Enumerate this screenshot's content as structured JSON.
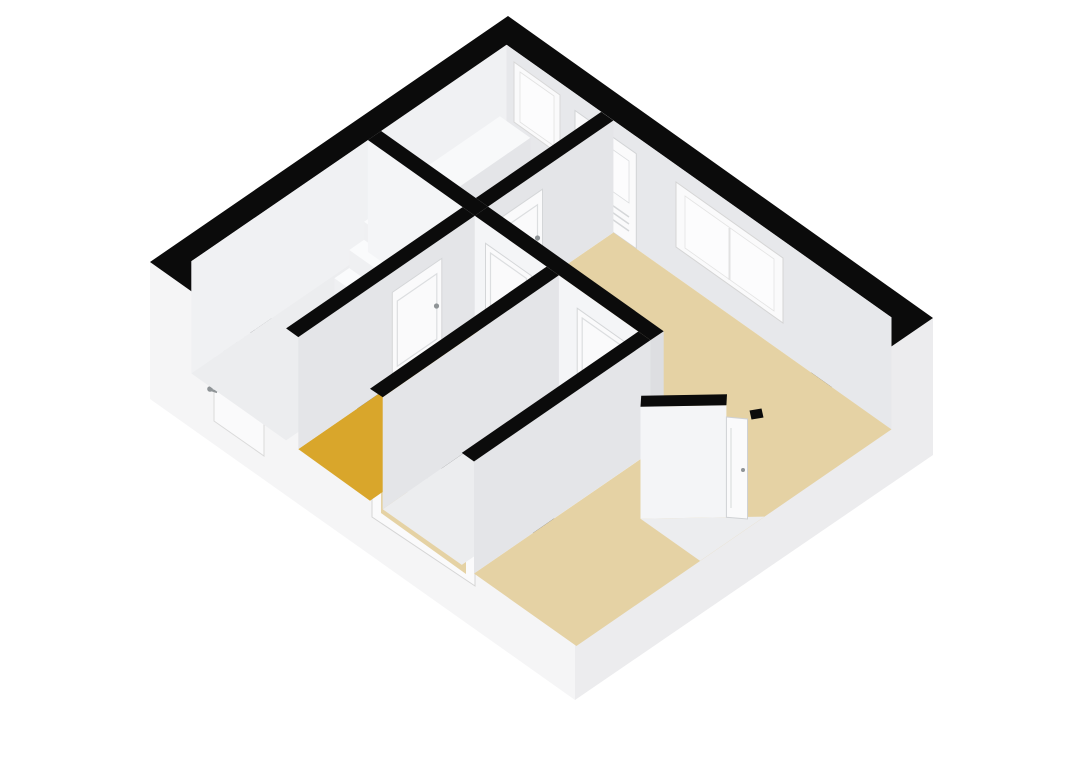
{
  "page": {
    "title": "3D isometric floor plan",
    "background": "#FFFFFF"
  },
  "colors": {
    "wall_cap": "#0B0B0B",
    "ext_face_light": "#F5F5F6",
    "ext_face_shade": "#ECECEE",
    "inner_face_nw": "#F0F1F3",
    "inner_face_ne": "#E7E8EB",
    "wall_face_lit": "#F4F5F7",
    "wall_face_shade": "#E4E5E8",
    "wall_face_dark": "#DDDEE1",
    "floor_living": "#E5D2A4",
    "floor_hall": "#D9A62B",
    "floor_bathroom": "#D9DFD7",
    "floor_neutral": "#ECEDEF",
    "door_white": "#FAFAFB",
    "frame_gray": "#D7D9DB",
    "glass_white": "#FCFCFD",
    "glass_tint": "#E9EDEF",
    "counter_white": "#F8F9FA",
    "metal": "#C6CBCE",
    "metal_shade": "#9EA3A6",
    "basin_rim": "#AEB3B5",
    "basin_mid": "#CDD1D2",
    "basin_bowl": "#9EA3A5",
    "basin_dark": "#7E8486",
    "handle_gray": "#8F9497",
    "step_top": "#FAFBFC",
    "step_riser": "#EFF0F2",
    "stringer": "#E8E9EB"
  },
  "scene": {
    "view": "isometric-3d-floorplan-dollhouse",
    "rooms": [
      {
        "id": "living-room",
        "floor": "floor_living",
        "features": [
          "large-window-ne",
          "window-sw",
          "diagonal-corner-closet"
        ]
      },
      {
        "id": "hallway",
        "floor": "floor_hall",
        "features": [
          "door-to-living-room",
          "door-to-bathroom",
          "door-to-storage"
        ]
      },
      {
        "id": "bathroom",
        "floor": "floor_bathroom",
        "features": [
          "washbasin",
          "counter",
          "window-ne",
          "glazed-exterior-door"
        ]
      },
      {
        "id": "stair-room",
        "floor": "floor_neutral",
        "features": [
          "staircase",
          "front-door"
        ]
      },
      {
        "id": "storage-room",
        "floor": "floor_neutral",
        "features": []
      },
      {
        "id": "corner-closet",
        "floor": "floor_neutral",
        "features": [
          "open-door-leaf"
        ]
      }
    ],
    "openings": {
      "windows": 3,
      "exterior_doors": 2,
      "interior_doors": 5
    },
    "fixtures": [
      "staircase",
      "washbasin",
      "counter"
    ]
  }
}
